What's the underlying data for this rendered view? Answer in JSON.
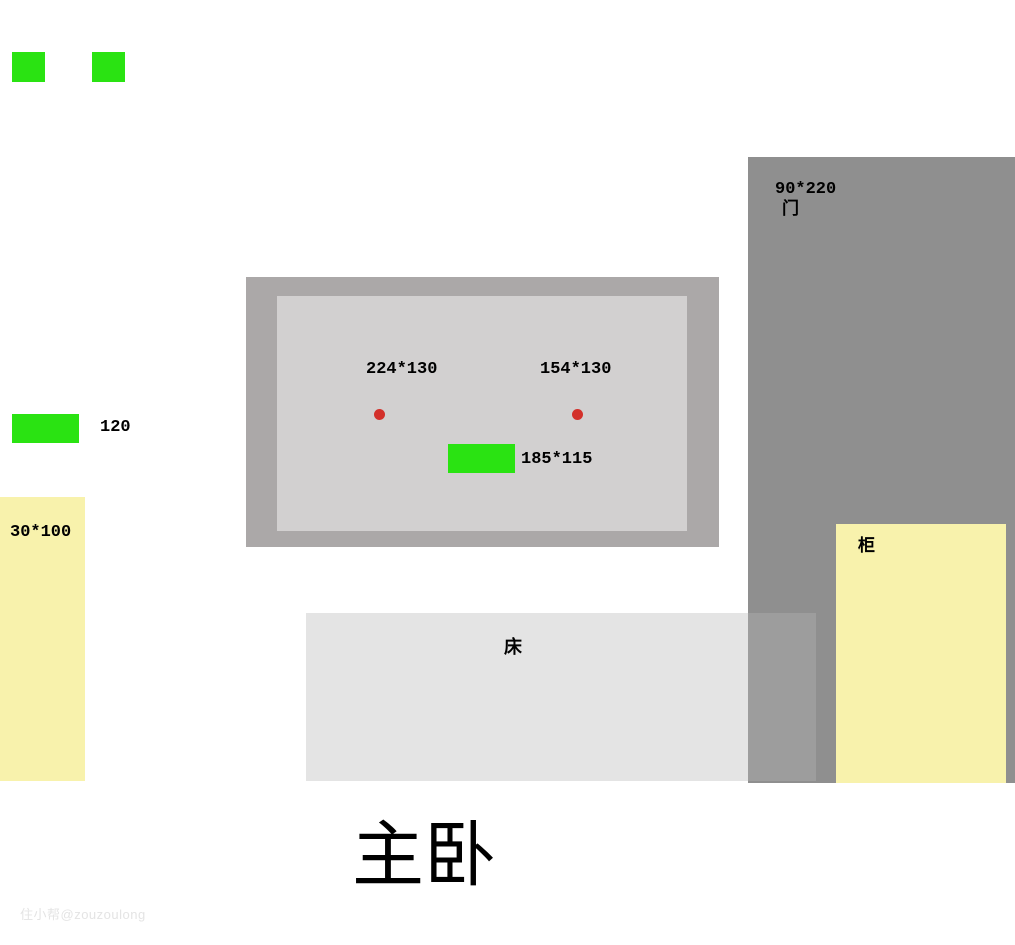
{
  "palette": {
    "green": "#2ae312",
    "yellow": "#f8f2ac",
    "door_gray": "#8f8f8f",
    "bed_gray": "#e4e4e4",
    "bed_door_overlap_gray": "#9d9d9d",
    "window_frame_gray": "#aba8a8",
    "window_glass_gray": "#d2d0d0",
    "red": "#d3302a",
    "watermark_gray": "#e4e4e4"
  },
  "title": "主卧",
  "watermark": "住小帮@zouzoulong",
  "door": {
    "size_label": "90*220",
    "name_label": "门"
  },
  "window": {
    "left_size_label": "224*130",
    "right_size_label": "154*130",
    "sill_size_label": "185*115"
  },
  "left_column": {
    "green_bar_label": "120",
    "yellow_bar_label": "30*100"
  },
  "bed": {
    "label": "床"
  },
  "cabinet": {
    "label": "柜"
  }
}
